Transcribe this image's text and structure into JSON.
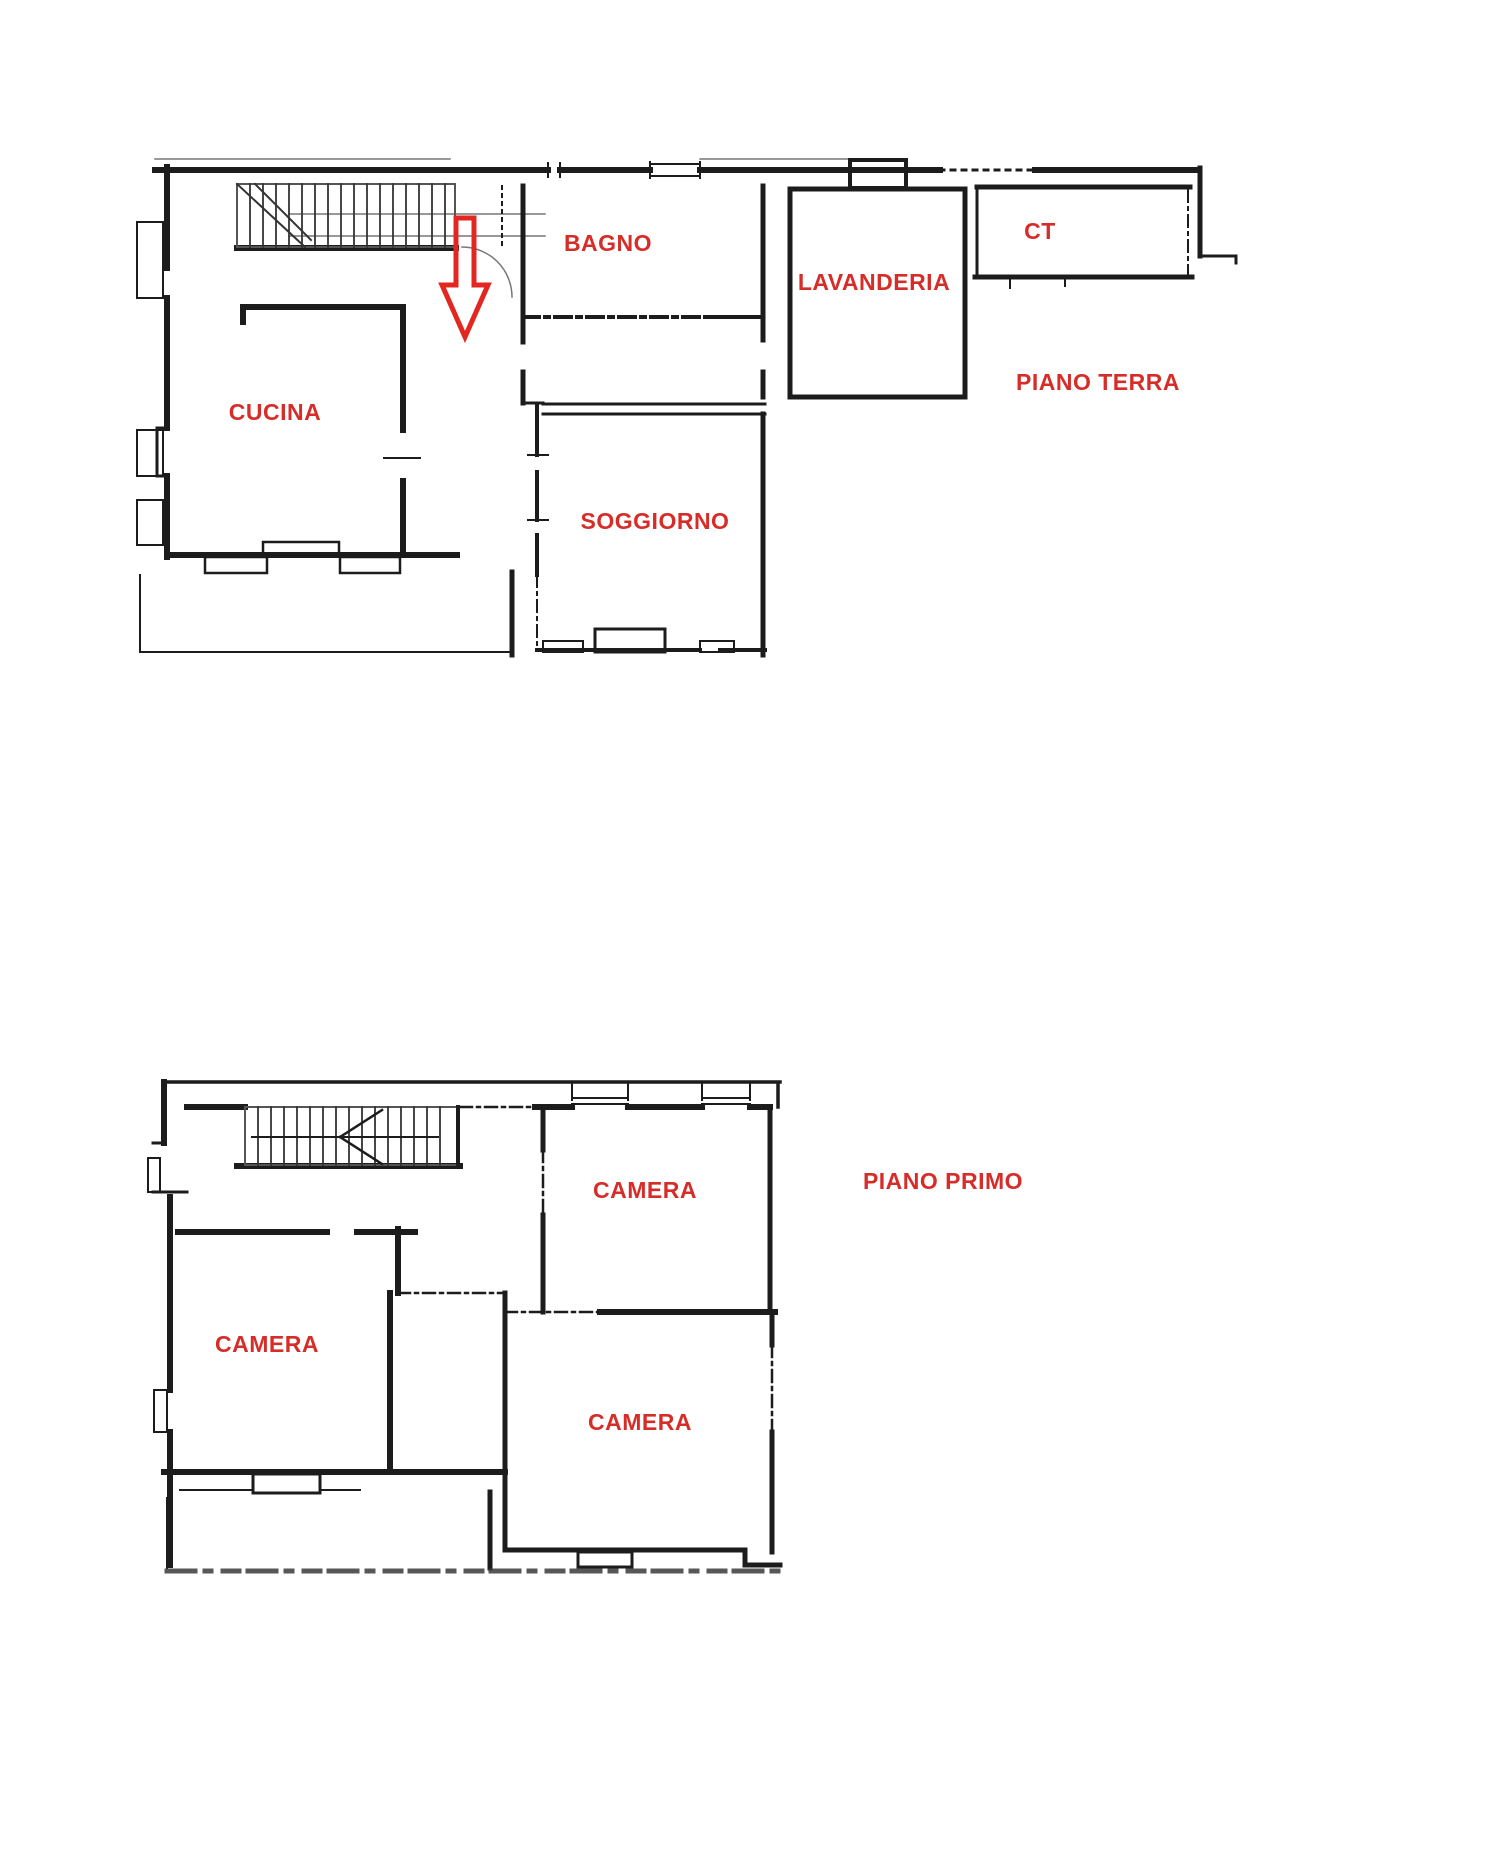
{
  "document": {
    "kind": "floor-plan drawing",
    "background": "#ffffff"
  },
  "colors": {
    "label_red": "#d62d28",
    "arrow_red": "#e22620",
    "terrace_gold": "#f9c315",
    "balcony_yellow": "#fef200",
    "wall": "#1c1c1c"
  },
  "ground_floor": {
    "title": "PIANO TERRA",
    "rooms": {
      "cucina": "CUCINA",
      "bagno": "BAGNO",
      "lavanderia": "LAVANDERIA",
      "ct": "CT",
      "soggiorno": "SOGGIORNO"
    }
  },
  "first_floor": {
    "title": "PIANO PRIMO",
    "rooms": {
      "camera_top": "CAMERA",
      "camera_left": "CAMERA",
      "camera_bottom": "CAMERA"
    }
  }
}
